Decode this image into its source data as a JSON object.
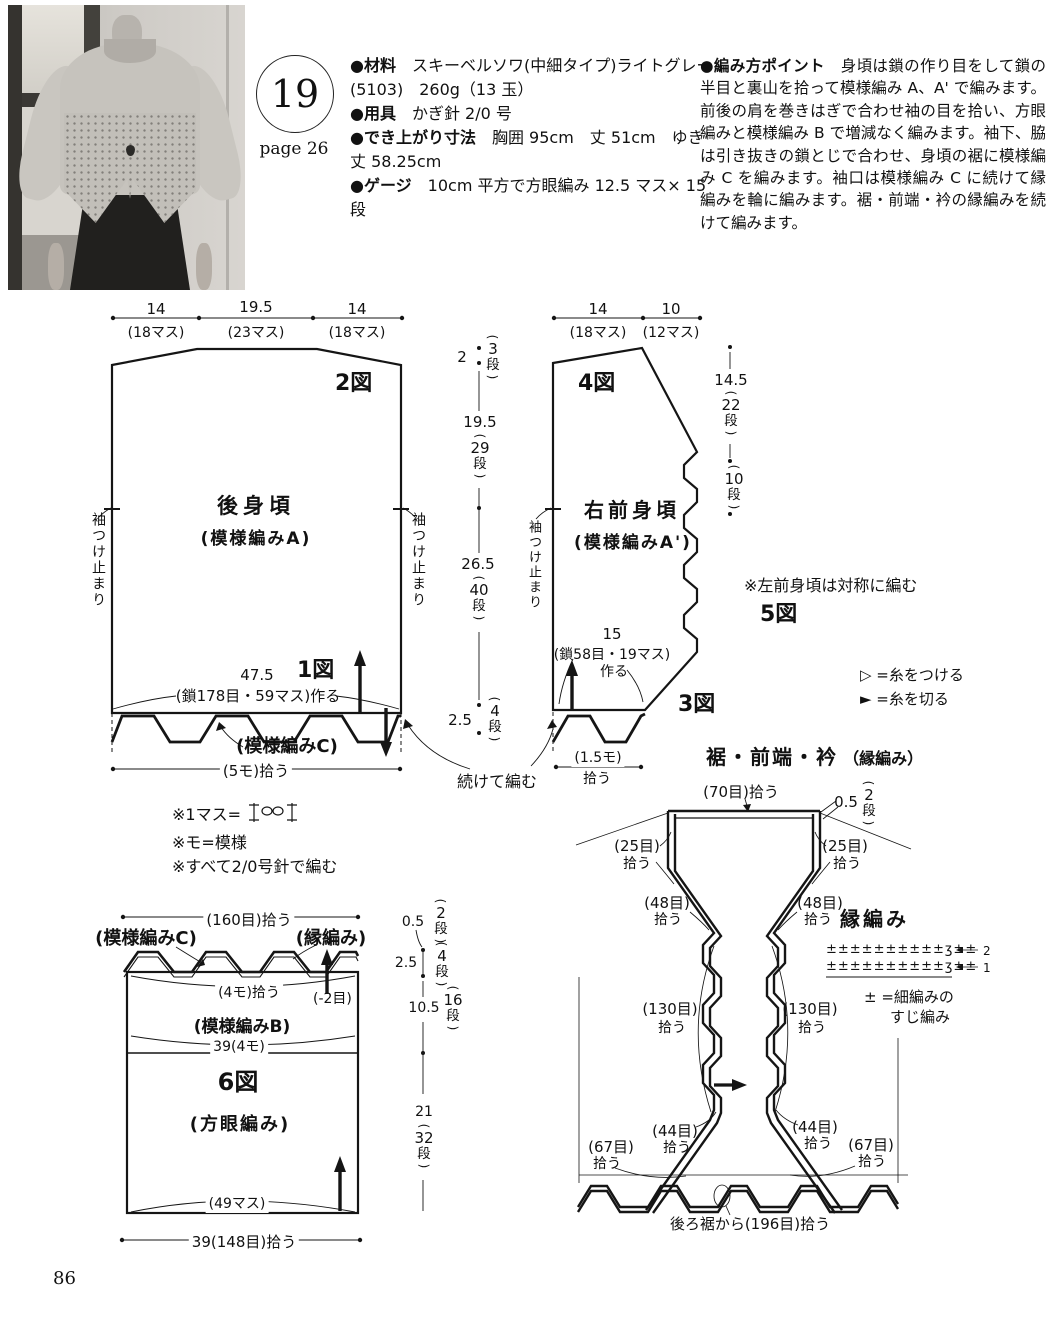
{
  "glyphs": {
    "op": "(",
    "cp": ")"
  },
  "page": {
    "number": "86"
  },
  "header": {
    "item_no": "19",
    "page_ref": "page 26",
    "materials": [
      {
        "b": "●材料",
        "t": "　スキーベルソワ(中細タイプ)ライトグレー"
      },
      {
        "b": "",
        "t": "(5103)　260g（13 玉）"
      },
      {
        "b": "●用具",
        "t": "　かぎ針 2/0 号"
      },
      {
        "b": "●でき上がり寸法",
        "t": "　胸囲 95cm　丈 51cm　ゆき"
      },
      {
        "b": "",
        "t": "丈 58.25cm"
      },
      {
        "b": "●ゲージ",
        "t": "　10cm 平方で方眼編み 12.5 マス× 15"
      },
      {
        "b": "",
        "t": "段"
      }
    ],
    "points_label": "●編み方ポイント",
    "points_text": "　身頃は鎖の作り目をして鎖の半目と裏山を拾って模様編み A、A' で編みます。前後の肩を巻きはぎで合わせ袖の目を拾い、方眼編みと模様編み B で増減なく編みます。袖下、脇は引き抜きの鎖とじで合わせ、身頃の裾に模様編み C を編みます。袖口は模様編み C に続けて縁編みを輪に編みます。裾・前端・衿の縁編みを続けて編みます。"
  },
  "back": {
    "fig2": "2図",
    "fig1": "1図",
    "meas_top": [
      {
        "num": "14",
        "sub": "(18マス)"
      },
      {
        "num": "19.5",
        "sub": "(23マス)"
      },
      {
        "num": "14",
        "sub": "(18マス)"
      }
    ],
    "name": "後身頃",
    "pattern": "(模様編みA)",
    "cast_on_num": "47.5",
    "cast_on": "(鎖178目・59マス)作る",
    "hem_pattern": "(模様編みC)",
    "hem_pick": "(5モ)拾う",
    "sleeve_stop": "袖つけ止まり",
    "continue_label": "続けて編む",
    "col": {
      "v1": "2",
      "b1": {
        "n": "3",
        "u": "段"
      },
      "v2": "19.5",
      "b2": {
        "n": "29",
        "u": "段"
      },
      "v3": "26.5",
      "b3": {
        "n": "40",
        "u": "段"
      },
      "v4": "2.5",
      "b4": {
        "n": "4",
        "u": "段"
      }
    }
  },
  "front": {
    "fig4": "4図",
    "fig3": "3図",
    "fig5": "5図",
    "meas_top": [
      {
        "num": "14",
        "sub": "(18マス)"
      },
      {
        "num": "10",
        "sub": "(12マス)"
      }
    ],
    "name": "右前身頃",
    "pattern": "(模様編みA')",
    "right_col": {
      "v1": "14.5",
      "b1": {
        "n": "22",
        "u": "段"
      },
      "b2": {
        "n": "10",
        "u": "段"
      }
    },
    "cast_on_num": "15",
    "cast_on": "(鎖58目・19マス)",
    "cast_on2": "作る",
    "hem_pick1": "(1.5モ)",
    "hem_pick2": "拾う",
    "sleeve_stop": "袖つけ止まり",
    "note": "※左前身頃は対称に編む",
    "legend_attach": "▷ =糸をつける",
    "legend_cut": "► =糸を切る"
  },
  "notes": {
    "n1": "※1マス=",
    "n2": "※モ=模様",
    "n3": "※すべて2/0号針で編む"
  },
  "sleeve": {
    "fig6": "6図",
    "top_pick": "(160目)拾う",
    "patternC": "(模様編みC)",
    "edge": "(縁編み)",
    "pick4mo": "(4モ)拾う",
    "minus2": "(-2目)",
    "patternB": "(模様編みB)",
    "w39": "39(4モ)",
    "square": "(方眼編み)",
    "w49": "(49マス)",
    "bottom_pick": "39(148目)拾う",
    "col": {
      "v1": "0.5",
      "b1": {
        "n": "2",
        "u": "段"
      },
      "v2": "2.5",
      "b2": {
        "n": "4",
        "u": "段"
      },
      "v3": "10.5",
      "b3": {
        "n": "16",
        "u": "段"
      },
      "v4": "21",
      "b4": {
        "n": "32",
        "u": "段"
      }
    }
  },
  "edging": {
    "title": "裾・前端・衿",
    "title2": "（縁編み）",
    "top_pick": "(70目)拾う",
    "v05": "0.5",
    "b05": {
      "n": "2",
      "u": "段"
    },
    "pick25": "(25目)",
    "pick48": "(48目)",
    "pick130": "(130目)",
    "pick44": "(44目)",
    "pick67": "(67目)",
    "pick_word": "拾う",
    "label": "縁編み",
    "stitches": "±±±±±±±±±±ʒ±±",
    "row2": "2",
    "row1": "1",
    "legend1": "± =細編みの",
    "legend2": "すじ編み",
    "bottom_pick": "後ろ裾から(196目)拾う"
  }
}
